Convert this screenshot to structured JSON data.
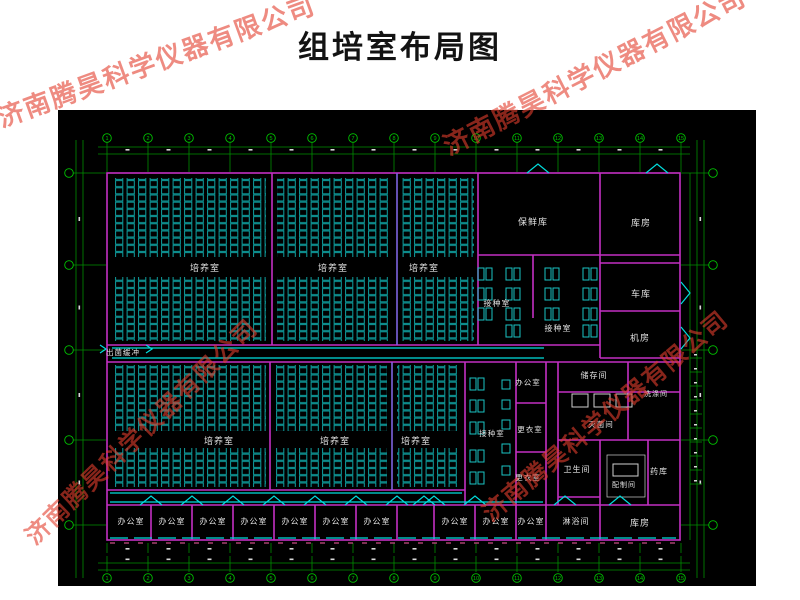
{
  "title": "组培室布局图",
  "watermark": {
    "text": "济南腾昊科学仪器有限公司",
    "color": "rgba(226,62,45,0.60)",
    "instances": [
      {
        "x": 156,
        "y": 60,
        "angle": -20,
        "size": 26
      },
      {
        "x": 594,
        "y": 70,
        "angle": -27,
        "size": 26
      },
      {
        "x": 140,
        "y": 430,
        "angle": -44,
        "size": 24
      },
      {
        "x": 604,
        "y": 414,
        "angle": -40,
        "size": 24
      }
    ]
  },
  "colors": {
    "canvas": "#000000",
    "wall": "#c32fc3",
    "divider": "#7d63e0",
    "rack": "#0fa0a0",
    "door": "#00dede",
    "dim": "#008f00",
    "dimBright": "#00c400",
    "label": "#e2e2e2",
    "window_pink": "#c94d85",
    "table": "#1ac4c4",
    "equip": "#cfcfcf"
  },
  "plan": {
    "canvas": [
      58,
      110,
      698,
      476
    ],
    "outer": [
      107,
      173,
      573,
      367
    ],
    "walls": [
      [
        272,
        173,
        272,
        345
      ],
      [
        478,
        173,
        478,
        345
      ],
      [
        533,
        255,
        533,
        318
      ],
      [
        600,
        173,
        600,
        358
      ],
      [
        478,
        255,
        680,
        255
      ],
      [
        600,
        263,
        680,
        263
      ],
      [
        600,
        311,
        680,
        311
      ],
      [
        600,
        358,
        680,
        358
      ],
      [
        107,
        345,
        600,
        345
      ],
      [
        107,
        362,
        680,
        362
      ],
      [
        270,
        362,
        270,
        490
      ],
      [
        465,
        362,
        465,
        505
      ],
      [
        516,
        362,
        516,
        540
      ],
      [
        516,
        403,
        546,
        403
      ],
      [
        516,
        452,
        546,
        452
      ],
      [
        546,
        362,
        546,
        540
      ],
      [
        107,
        490,
        465,
        490
      ],
      [
        107,
        505,
        680,
        505
      ],
      [
        558,
        362,
        558,
        505
      ],
      [
        558,
        392,
        680,
        392
      ],
      [
        628,
        362,
        628,
        440
      ],
      [
        558,
        440,
        680,
        440
      ],
      [
        600,
        440,
        600,
        540
      ],
      [
        648,
        440,
        648,
        505
      ],
      [
        558,
        497,
        600,
        497
      ],
      [
        151,
        505,
        151,
        540
      ],
      [
        192,
        505,
        192,
        540
      ],
      [
        233,
        505,
        233,
        540
      ],
      [
        274,
        505,
        274,
        540
      ],
      [
        315,
        505,
        315,
        540
      ],
      [
        356,
        505,
        356,
        540
      ],
      [
        397,
        505,
        397,
        540
      ],
      [
        434,
        505,
        434,
        540
      ],
      [
        475,
        505,
        475,
        540
      ]
    ],
    "purple_walls": [
      [
        397,
        173,
        397,
        345
      ],
      [
        392,
        362,
        392,
        490
      ]
    ],
    "corridors": [
      [
        112,
        348,
        544,
        348
      ],
      [
        112,
        358,
        544,
        358
      ],
      [
        110,
        493,
        462,
        493
      ],
      [
        110,
        502,
        543,
        502
      ]
    ],
    "windows": {
      "cyan": [
        110,
        538,
        676,
        538
      ],
      "pink": [
        110,
        543,
        676,
        543
      ]
    },
    "racks": [
      [
        113,
        178,
        153,
        79
      ],
      [
        113,
        277,
        153,
        64
      ],
      [
        277,
        178,
        114,
        79
      ],
      [
        277,
        277,
        114,
        64
      ],
      [
        402,
        178,
        72,
        79
      ],
      [
        402,
        277,
        72,
        64
      ],
      [
        112,
        365,
        154,
        66
      ],
      [
        112,
        448,
        154,
        39
      ],
      [
        275,
        365,
        112,
        66
      ],
      [
        275,
        448,
        112,
        39
      ],
      [
        397,
        365,
        63,
        66
      ],
      [
        397,
        448,
        63,
        39
      ]
    ],
    "tables_pair": [
      [
        478,
        268
      ],
      [
        478,
        288
      ],
      [
        478,
        308
      ],
      [
        506,
        268
      ],
      [
        506,
        288
      ],
      [
        506,
        308
      ],
      [
        506,
        325
      ],
      [
        545,
        268
      ],
      [
        545,
        288
      ],
      [
        545,
        308
      ],
      [
        583,
        268
      ],
      [
        583,
        288
      ],
      [
        583,
        308
      ],
      [
        583,
        325
      ],
      [
        470,
        378
      ],
      [
        470,
        400
      ],
      [
        470,
        422
      ],
      [
        470,
        450
      ],
      [
        470,
        472
      ]
    ],
    "tables_small": [
      [
        502,
        380
      ],
      [
        502,
        400
      ],
      [
        502,
        420
      ],
      [
        502,
        444
      ],
      [
        502,
        466
      ]
    ],
    "boxes": [
      [
        572,
        394,
        16,
        13
      ],
      [
        594,
        394,
        16,
        13
      ],
      [
        616,
        394,
        16,
        13
      ],
      [
        613,
        464,
        25,
        12
      ]
    ],
    "white_rects": [
      [
        607,
        455,
        38,
        42
      ]
    ],
    "doors_up": [
      [
        538,
        173
      ],
      [
        657,
        173
      ],
      [
        151,
        505
      ],
      [
        192,
        505
      ],
      [
        233,
        505
      ],
      [
        274,
        505
      ],
      [
        315,
        505
      ],
      [
        356,
        505
      ],
      [
        397,
        505
      ],
      [
        424,
        505
      ],
      [
        434,
        505
      ],
      [
        475,
        505
      ],
      [
        565,
        505
      ],
      [
        620,
        505
      ]
    ],
    "doors_right": [
      [
        681,
        293
      ],
      [
        681,
        338
      ]
    ],
    "zigzags": [
      [
        100,
        349
      ],
      [
        146,
        349
      ]
    ],
    "labels": [
      {
        "t": "培养室",
        "x": 205,
        "y": 271,
        "s": 9
      },
      {
        "t": "培养室",
        "x": 333,
        "y": 271,
        "s": 9
      },
      {
        "t": "培养室",
        "x": 424,
        "y": 271,
        "s": 9
      },
      {
        "t": "培养室",
        "x": 219,
        "y": 444,
        "s": 9
      },
      {
        "t": "培养室",
        "x": 335,
        "y": 444,
        "s": 9
      },
      {
        "t": "培养室",
        "x": 416,
        "y": 444,
        "s": 9
      },
      {
        "t": "保鲜库",
        "x": 533,
        "y": 225,
        "s": 9
      },
      {
        "t": "库房",
        "x": 641,
        "y": 226,
        "s": 9
      },
      {
        "t": "接种室",
        "x": 497,
        "y": 306,
        "s": 8
      },
      {
        "t": "接种室",
        "x": 558,
        "y": 331,
        "s": 8
      },
      {
        "t": "车库",
        "x": 641,
        "y": 297,
        "s": 9
      },
      {
        "t": "机房",
        "x": 640,
        "y": 341,
        "s": 9
      },
      {
        "t": "出菌缓冲",
        "x": 123,
        "y": 355,
        "s": 7.5
      },
      {
        "t": "办公室",
        "x": 528,
        "y": 385,
        "s": 7.5
      },
      {
        "t": "更衣室",
        "x": 530,
        "y": 432,
        "s": 7.5
      },
      {
        "t": "接种室",
        "x": 492,
        "y": 436,
        "s": 7.5
      },
      {
        "t": "更衣室",
        "x": 528,
        "y": 480,
        "s": 7.5
      },
      {
        "t": "储存间",
        "x": 594,
        "y": 378,
        "s": 8
      },
      {
        "t": "洗涤间",
        "x": 656,
        "y": 396,
        "s": 7
      },
      {
        "t": "灭菌间",
        "x": 601,
        "y": 427,
        "s": 7.5
      },
      {
        "t": "卫生间",
        "x": 577,
        "y": 472,
        "s": 8
      },
      {
        "t": "配制间",
        "x": 624,
        "y": 487,
        "s": 7
      },
      {
        "t": "药库",
        "x": 659,
        "y": 474,
        "s": 8
      },
      {
        "t": "办公室",
        "x": 131,
        "y": 524,
        "s": 8
      },
      {
        "t": "办公室",
        "x": 172,
        "y": 524,
        "s": 8
      },
      {
        "t": "办公室",
        "x": 213,
        "y": 524,
        "s": 8
      },
      {
        "t": "办公室",
        "x": 254,
        "y": 524,
        "s": 8
      },
      {
        "t": "办公室",
        "x": 295,
        "y": 524,
        "s": 8
      },
      {
        "t": "办公室",
        "x": 336,
        "y": 524,
        "s": 8
      },
      {
        "t": "办公室",
        "x": 377,
        "y": 524,
        "s": 8
      },
      {
        "t": "办公室",
        "x": 455,
        "y": 524,
        "s": 8
      },
      {
        "t": "办公室",
        "x": 496,
        "y": 524,
        "s": 8
      },
      {
        "t": "办公室",
        "x": 531,
        "y": 524,
        "s": 8
      },
      {
        "t": "淋浴间",
        "x": 576,
        "y": 524,
        "s": 8
      },
      {
        "t": "库房",
        "x": 640,
        "y": 526,
        "s": 9
      }
    ],
    "grid": {
      "cols": [
        107,
        148,
        189,
        230,
        271,
        312,
        353,
        394,
        435,
        476,
        517,
        558,
        599,
        640,
        681
      ],
      "col_nums": [
        "1",
        "2",
        "3",
        "4",
        "5",
        "6",
        "7",
        "8",
        "9",
        "10",
        "11",
        "12",
        "13",
        "14",
        "15"
      ],
      "rows": [
        173,
        265,
        350,
        440,
        525
      ],
      "top": {
        "lines_y": [
          147,
          154
        ],
        "bubble_y": 138,
        "tick_y1": 142,
        "tick_y2": 172
      },
      "bottom": {
        "lines_y": [
          563,
          570
        ],
        "bubble_y": 578,
        "tick_y1": 556,
        "tick_y2": 572,
        "inner_tick": [
          543,
          553
        ],
        "inner_dash_y": 548
      },
      "left": {
        "lines_x": [
          76,
          83
        ],
        "bubble_x": 69,
        "tick_x1": 68,
        "tick_x2": 106
      },
      "right": {
        "lines_x": [
          697,
          704
        ],
        "bubble_x": 713,
        "tick_x1": 681,
        "tick_x2": 710,
        "extra_v": 690,
        "dense": {
          "x1": 690,
          "x2": 702,
          "y1": 358,
          "y2": 494,
          "step": 14
        }
      }
    }
  }
}
